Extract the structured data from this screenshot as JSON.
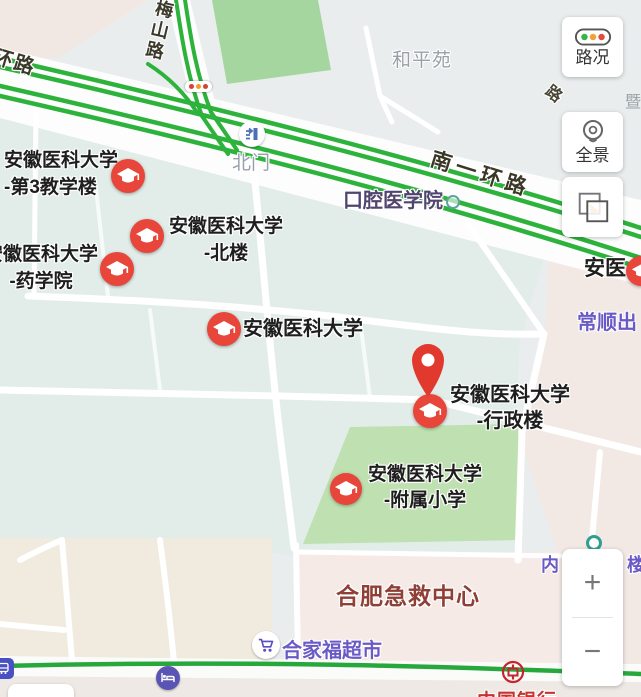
{
  "map": {
    "road_labels": {
      "ring_road_partial": "环路",
      "meishan_road": "梅山路",
      "nanyi_ring_road": "南一环路",
      "road_char_partial": "路",
      "edge_char_partial": "暨"
    },
    "area_labels": {
      "heping_yuan": "和平苑",
      "stomatology_college": "口腔医学院",
      "changshun_partial": "常顺出",
      "building_left_partial": "内",
      "building_right_partial": "楼",
      "emergency_center": "合肥急救中心",
      "anyi_partial": "安医"
    },
    "poi": {
      "north_gate": "北门",
      "supermarket": "合家福超市",
      "bank": "中国银行"
    },
    "markers": [
      {
        "line1": "安徽医科大学",
        "line2": "-第3教学楼"
      },
      {
        "line1": "安徽医科大学",
        "line2": "-北楼"
      },
      {
        "line1": "安徽医科大学",
        "line2": "-药学院"
      },
      {
        "line1": "安徽医科大学",
        "line2": ""
      },
      {
        "line1": "安徽医科大学",
        "line2": "-行政楼"
      },
      {
        "line1": "安徽医科大学",
        "line2": "-附属小学"
      }
    ]
  },
  "controls": {
    "traffic": "路况",
    "panorama": "全景",
    "zoom_in": "+",
    "zoom_out": "−"
  },
  "colors": {
    "road_green": "#2db33c",
    "marker_red": "#e8463b",
    "label_purple": "#6a5ac6",
    "emergency_red": "#8e4036",
    "bank_red": "#c23630",
    "park_green": "#a6d69f",
    "school_green": "#bfe0b0"
  }
}
